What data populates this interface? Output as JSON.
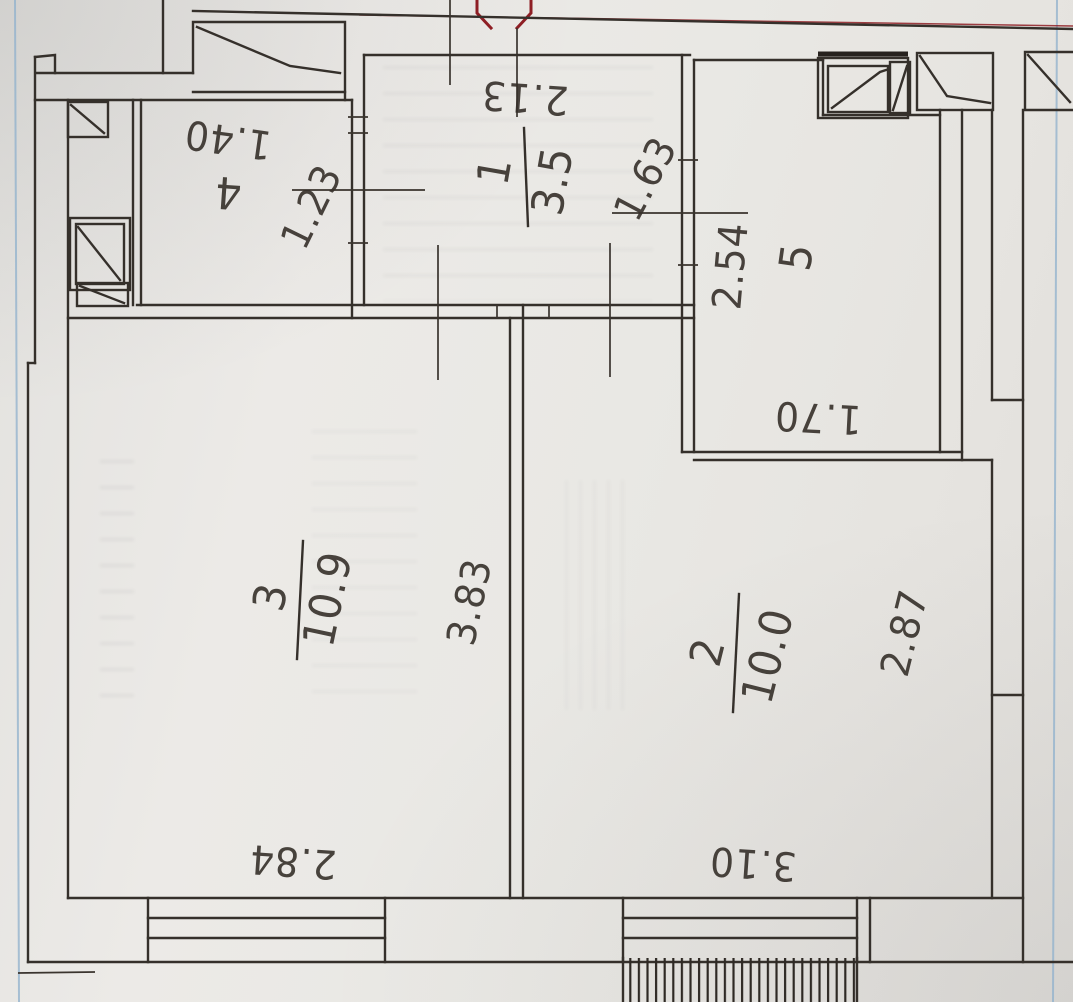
{
  "document": {
    "kind": "scanned apartment floor plan photo",
    "marker_note": "partial red octagon stamp at top edge"
  },
  "rooms": {
    "r1": {
      "number": "1",
      "area": "3.5"
    },
    "r2": {
      "number": "2",
      "area": "10.0"
    },
    "r3": {
      "number": "3",
      "area": "10.9"
    },
    "r4": {
      "number": "4"
    },
    "r5": {
      "number": "5"
    }
  },
  "dimensions": {
    "hall_width": "2.13",
    "hall_west_opening": "1.23",
    "hall_east_opening": "1.63",
    "room4_width": "1.40",
    "room5_height": "2.54",
    "room5_width": "1.70",
    "room3_height": "3.83",
    "room3_width": "2.84",
    "room2_height": "2.87",
    "room2_width": "3.10"
  },
  "colors": {
    "ink": "#35302b",
    "red_marker": "#8e1e24",
    "paper": "#e9e8e4",
    "blue_edge": "#8fb0cc"
  }
}
